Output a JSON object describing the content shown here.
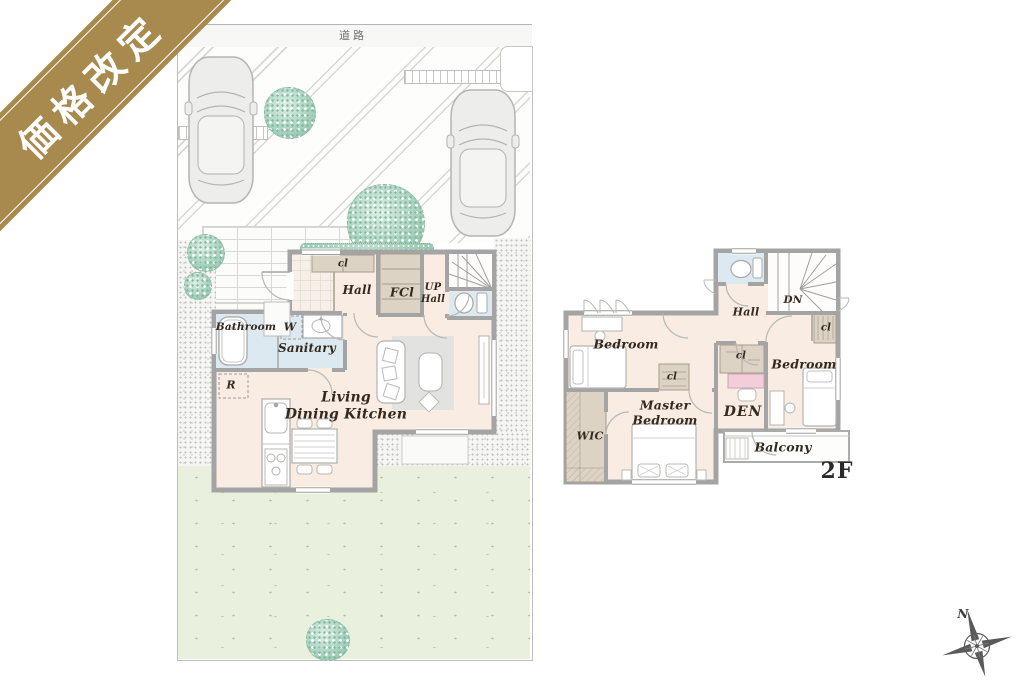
{
  "ribbon": {
    "label": "価格改定"
  },
  "site_plan": {
    "road_label": "道路",
    "compass_north_label": "N"
  },
  "floor1": {
    "hall_closet_label": "cl",
    "hall_label": "Hall",
    "front_closet_label": "FCl",
    "entrance_hall_label_line1": "UP",
    "entrance_hall_label_line2": "Hall",
    "bathroom_label": "Bathroom",
    "washer_label": "W",
    "sanitary_label": "Sanitary",
    "refrigerator_label": "R",
    "ldk_label_line1": "Living",
    "ldk_label_line2": "Dining Kitchen"
  },
  "floor2": {
    "stairs_down_label": "DN",
    "hall_label": "Hall",
    "bedroom_west_label": "Bedroom",
    "bedroom_west_closet_label": "cl",
    "bedroom_east_label": "Bedroom",
    "bedroom_east_closet_label": "cl",
    "master_bedroom_label_line1": "Master",
    "master_bedroom_label_line2": "Bedroom",
    "den_label": "DEN",
    "den_closet_label": "cl",
    "walk_in_closet_label": "WIC",
    "balcony_label": "Balcony",
    "floor_tag": "2F"
  },
  "colors": {
    "ribbon_gold": "#a8894e",
    "floor_fill": "#f8ece3",
    "wet_area_fill": "#dde9f1",
    "closet_fill": "#ddd3c4",
    "den_desk_pink": "#f3cdd9",
    "lawn_green": "#e9f0de",
    "tree_teal": "#8fc3ab",
    "wall_gray": "#a4a4a4"
  }
}
